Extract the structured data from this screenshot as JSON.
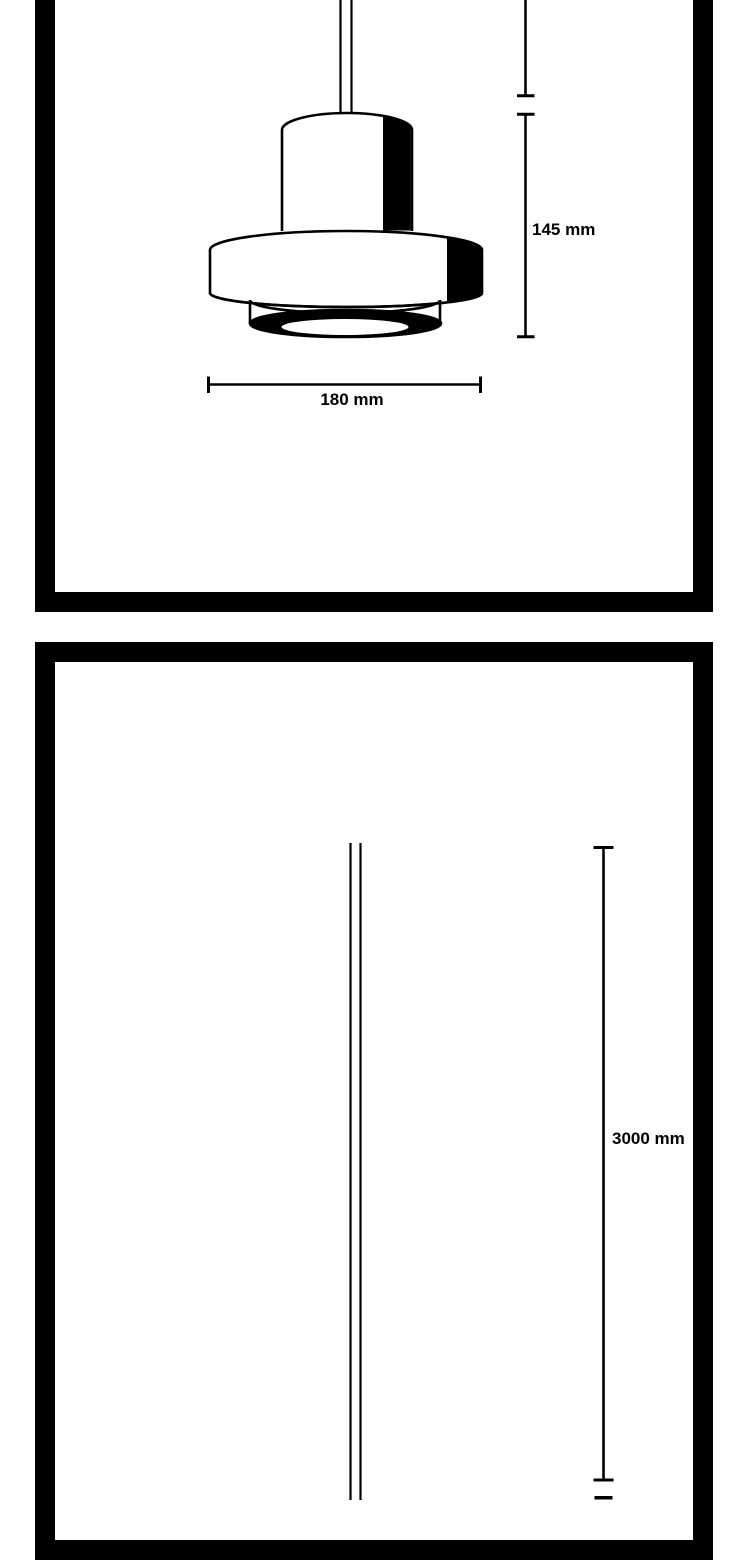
{
  "colors": {
    "ink": "#000000",
    "paper": "#ffffff"
  },
  "top_panel": {
    "illustration": "pendant-lamp-line-drawing",
    "height_dimension_label": "145 mm",
    "width_dimension_label": "180 mm"
  },
  "bottom_panel": {
    "illustration": "suspension-cable-line-drawing",
    "cable_length_label": "3000 mm"
  }
}
